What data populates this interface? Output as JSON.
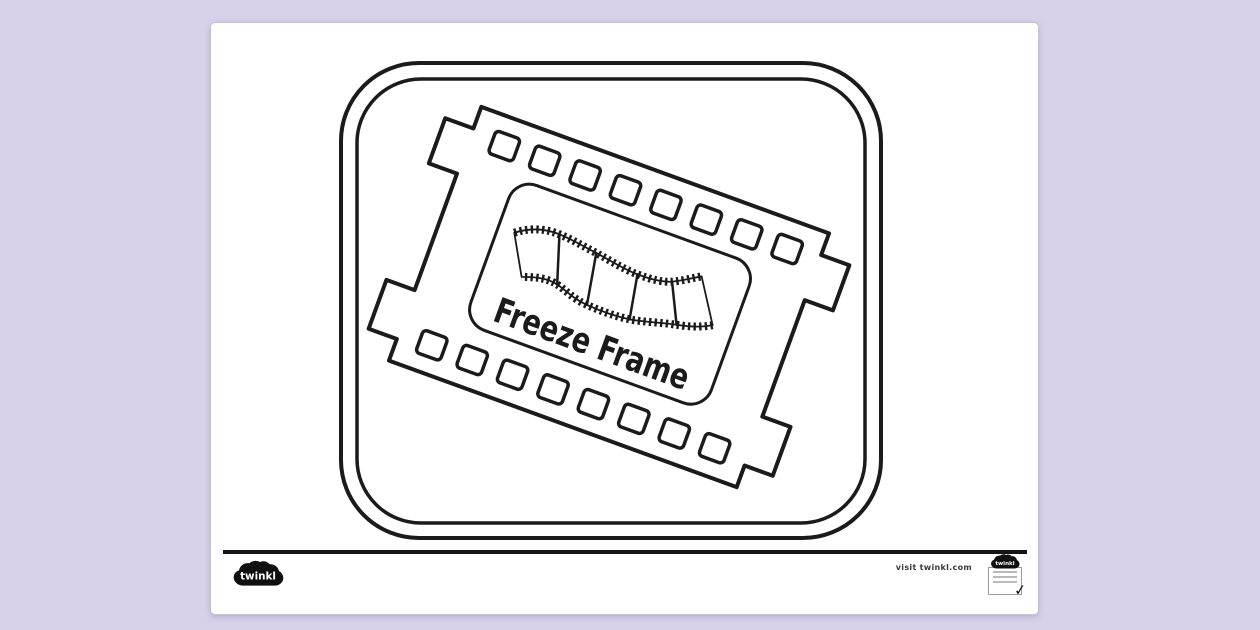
{
  "document": {
    "title": "Freeze Frame",
    "background_color": "#d7d1ea",
    "sheet_color": "#ffffff",
    "ink_color": "#1b1b1b"
  },
  "footer": {
    "brand": "twinkl",
    "visit_text": "visit twinkl.com",
    "badge_brand": "twinkl",
    "badge_check": "✓"
  }
}
